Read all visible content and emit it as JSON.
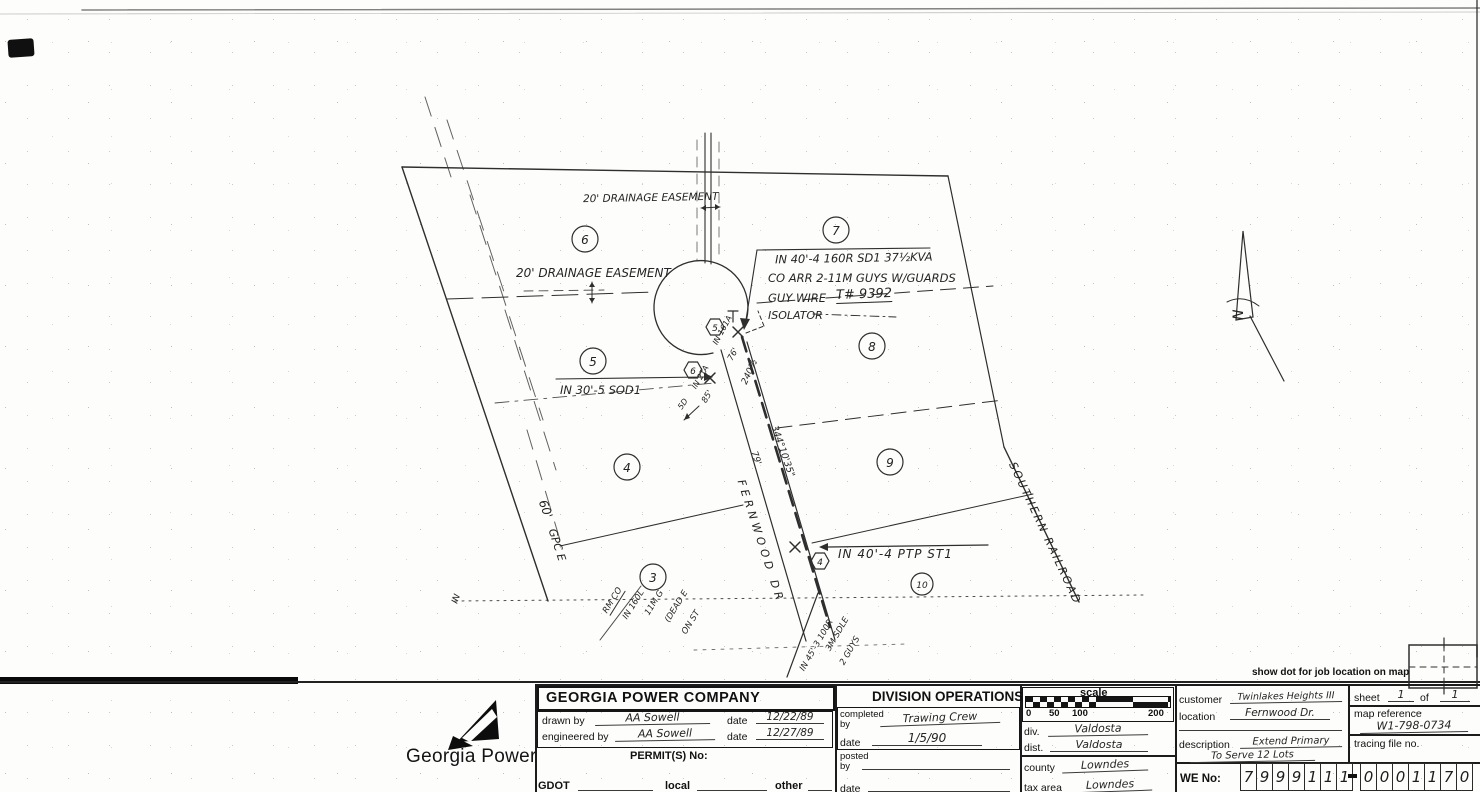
{
  "page": {
    "show_dot": "show dot for job location on map"
  },
  "drawing": {
    "labels": {
      "easement_top": "20' DRAINAGE EASEMENT",
      "easement_left": "20' DRAINAGE EASEMENT",
      "note1": "IN 40'-4 160R SD1 37½KVA",
      "note2": "CO ARR  2-11M GUYS W/GUARDS",
      "note3a": "GUY WIRE",
      "note3b": "T# 9392",
      "note4": "ISOLATOR",
      "sod": "IN 30'-5 SOD1",
      "ptp": "IN 40'-4 PTP ST1",
      "street": "FERNWOOD DR",
      "railroad": "SOUTHERN RAILROAD",
      "gpc": "GPC E",
      "dim60": "60'",
      "north": "N",
      "in_small": "IN",
      "tap161": "IN 161A",
      "len76": "76'",
      "len240": "240½",
      "tap2ta": "IN 2TA",
      "len85": "85'",
      "sd": "5D",
      "bearing": "344°10'35\"",
      "len79": "79'"
    },
    "left_notes": [
      "RM CO",
      "IN 160L",
      "11M G",
      "(DEAD E",
      "ON ST"
    ],
    "right_notes": [
      "IN 45'-3 100R",
      "3M SDLE",
      "2 GUYS"
    ],
    "lots": [
      "6",
      "7",
      "5",
      "8",
      "4",
      "9",
      "3",
      "10"
    ],
    "poles": [
      "5",
      "6",
      "4"
    ]
  },
  "titleblock": {
    "company": "GEORGIA POWER COMPANY",
    "division": "DIVISION OPERATIONS",
    "drawn_by_label": "drawn by",
    "drawn_by": "AA Sowell",
    "date_label1": "date",
    "drawn_date": "12/22/89",
    "engineered_by_label": "engineered by",
    "engineered_by": "AA Sowell",
    "date_label2": "date",
    "eng_date": "12/27/89",
    "permits_label": "PERMIT(S) No:",
    "gdot_label": "GDOT",
    "local_label": "local",
    "other_label": "other",
    "completed_by_label": "completed",
    "by_label": "by",
    "completed_by": "Trawing Crew",
    "date_label3": "date",
    "completed_date": "1/5/90",
    "posted_label": "posted",
    "posted_by_label": "by",
    "date_label4": "date",
    "scale_label": "scale",
    "scale_ticks": [
      "0",
      "50",
      "100",
      "200"
    ],
    "div_label": "div.",
    "div_value": "Valdosta",
    "dist_label": "dist.",
    "dist_value": "Valdosta",
    "county_label": "county",
    "county_value": "Lowndes",
    "tax_label": "tax area",
    "tax_value": "Lowndes",
    "customer_label": "customer",
    "customer_value": "Twinlakes Heights III",
    "location_label": "location",
    "location_value": "Fernwood Dr.",
    "description_label": "description",
    "description_value1": "Extend Primary",
    "description_value2": "To Serve 12 Lots",
    "sheet_label": "sheet",
    "sheet_value": "1",
    "of_label": "of",
    "sheet_total": "1",
    "map_ref_label": "map reference",
    "map_ref_value": "W1-798-0734",
    "tracing_label": "tracing file no.",
    "we_label": "WE No:",
    "we_group1": [
      "7",
      "9",
      "9",
      "9",
      "1",
      "1",
      "1"
    ],
    "we_group2": [
      "0",
      "0",
      "0",
      "1",
      "1",
      "7",
      "0"
    ]
  },
  "logo": {
    "text": "Georgia Power"
  }
}
